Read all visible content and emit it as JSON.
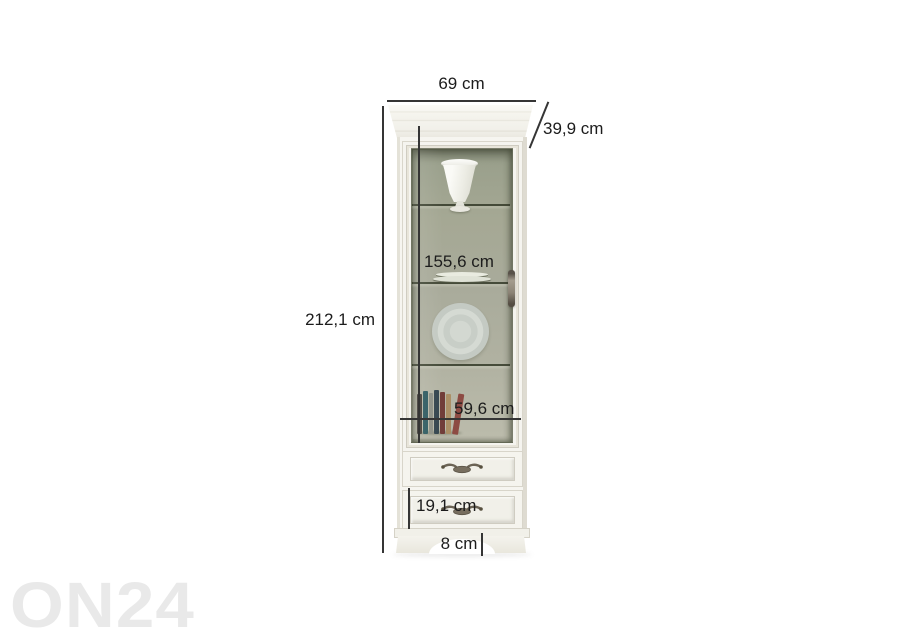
{
  "watermark": {
    "text": "ON24",
    "color": "#e9e9e9"
  },
  "dimensions": {
    "width": {
      "label": "69 cm",
      "value_cm": 69
    },
    "depth": {
      "label": "39,9 cm",
      "value_cm": 39.9
    },
    "height": {
      "label": "212,1 cm",
      "value_cm": 212.1
    },
    "glass_door_height": {
      "label": "155,6 cm",
      "value_cm": 155.6
    },
    "interior_width": {
      "label": "59,6 cm",
      "value_cm": 59.6
    },
    "drawer_height": {
      "label": "19,1 cm",
      "value_cm": 19.1
    },
    "plinth_height": {
      "label": "8 cm",
      "value_cm": 8
    }
  },
  "product": {
    "kind": "tall display cabinet with glass door and two drawers",
    "display_items": [
      "vase",
      "plate-stack",
      "plate",
      "books"
    ],
    "colors": {
      "body": "#f6f5f0",
      "interior_back": "#a9ab9b",
      "shelf_line": "#4a4f3e",
      "handle_metal": "#7b7264",
      "dimension_line": "#353535",
      "label_text": "#1c1c1c",
      "watermark": "#e9e9e9"
    }
  }
}
